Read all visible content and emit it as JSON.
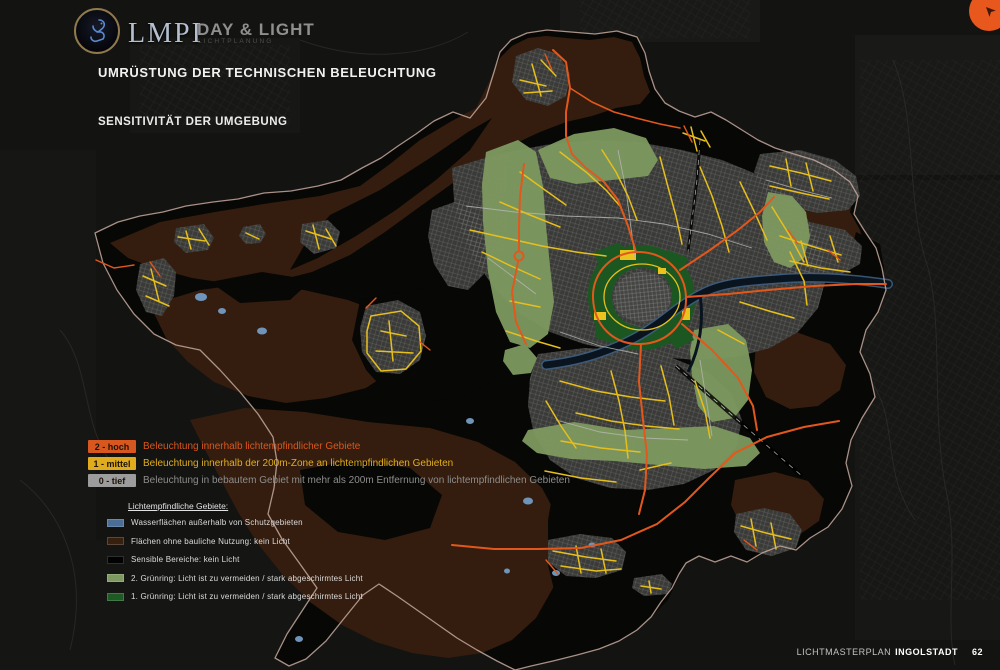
{
  "header": {
    "logo_text": "LMPI",
    "brand": "DAY & LIGHT",
    "brand_sub": "LICHTPLANUNG",
    "title": "UMRÜSTUNG DER TECHNISCHEN BELEUCHTUNG",
    "subtitle": "SENSITIVITÄT DER UMGEBUNG"
  },
  "legend_levels": {
    "items": [
      {
        "badge": "2 - hoch",
        "badge_color": "#d8571e",
        "text": "Beleuchtung innerhalb lichtempfindlicher Gebiete",
        "text_color": "#d8571e"
      },
      {
        "badge": "1 - mittel",
        "badge_color": "#e0ab1c",
        "text": "Beleuchtung innerhalb der 200m-Zone an lichtempfindlichen Gebieten",
        "text_color": "#dfae1e"
      },
      {
        "badge": "0 - tief",
        "badge_color": "#9c9c9c",
        "text": "Beleuchtung in bebautem Gebiet mit mehr als 200m Entfernung von lichtempfindlichen Gebieten",
        "text_color": "#8d8d8d"
      }
    ]
  },
  "legend_areas": {
    "heading": "Lichtempfindliche Gebiete:",
    "items": [
      {
        "swatch": "#4a6e96",
        "label": "Wasserflächen außerhalb von Schutzgebieten"
      },
      {
        "swatch": "#38200f",
        "label": "Flächen ohne bauliche Nutzung: kein Licht"
      },
      {
        "swatch": "#020202",
        "label": "Sensible Bereiche: kein Licht"
      },
      {
        "swatch": "#7e9960",
        "label": "2. Grünring: Licht ist zu vermeiden / stark abgeschirmtes Licht"
      },
      {
        "swatch": "#1d5a24",
        "label": "1. Grünring: Licht ist zu vermeiden / stark abgeschirmtes Licht"
      }
    ]
  },
  "footer": {
    "label": "LICHTMASTERPLAN",
    "city": "INGOLSTADT",
    "page": "62"
  },
  "icons": {
    "pointer": "➤",
    "logo": "lion-crest-icon"
  },
  "map_colors": {
    "background": "#131311",
    "municipal_boundary": "#c4a89c",
    "unlit_brown": "#341d0e",
    "sensitive_black": "#070705",
    "urban_gray": "#3a3a38",
    "greenring_2": "#7e9960",
    "greenring_1": "#1c5722",
    "water": "#6f94ba",
    "road_level_2": "#e2581c",
    "road_level_1": "#e6bf1c",
    "road_level_0": "#b6b6b2"
  }
}
